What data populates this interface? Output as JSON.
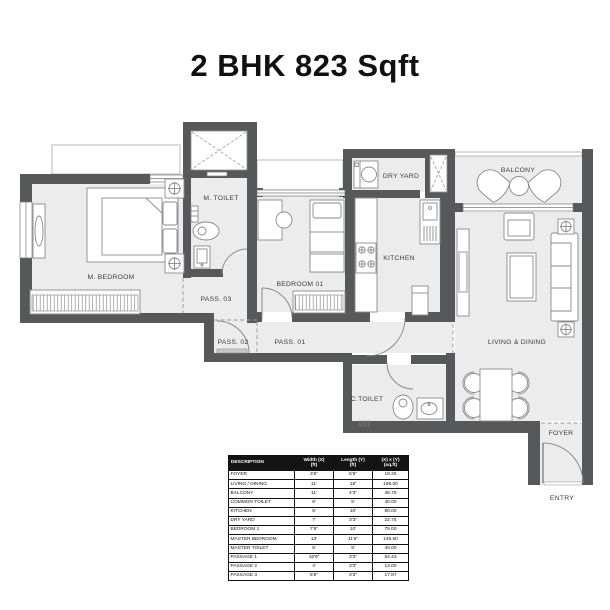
{
  "title": "2 BHK 823 Sqft",
  "plan": {
    "rooms": {
      "m_bedroom": "M. BEDROOM",
      "m_toilet": "M. TOILET",
      "bedroom_01": "BEDROOM 01",
      "kitchen": "KITCHEN",
      "dry_yard": "DRY YARD",
      "balcony": "BALCONY",
      "living_dining": "LIVING & DINING",
      "c_toilet": "C.TOILET",
      "pass_01": "PASS. 01",
      "pass_02": "PASS. 02",
      "pass_03": "PASS. 03",
      "foyer": "FOYER",
      "entry": "ENTRY"
    }
  },
  "table": {
    "headers": {
      "description": "DESCRIPTION",
      "width": "Width (X)",
      "width_unit": "(ft)",
      "length": "Length (Y)",
      "length_unit": "(ft)",
      "area": "(X) x (Y)",
      "area_unit": "(sq.ft)"
    },
    "rows": [
      {
        "d": "FOYER",
        "w": "3'6\"",
        "l": "5'6\"",
        "a": "19.25"
      },
      {
        "d": "LIVING / DINING",
        "w": "11'",
        "l": "18'",
        "a": "198.00"
      },
      {
        "d": "BALCONY",
        "w": "11'",
        "l": "4'3\"",
        "a": "46.75"
      },
      {
        "d": "COMMON TOILET",
        "w": "8'",
        "l": "5'",
        "a": "40.00"
      },
      {
        "d": "KITCHEN",
        "w": "8'",
        "l": "10'",
        "a": "80.00"
      },
      {
        "d": "DRY YARD",
        "w": "7'",
        "l": "3'3\"",
        "a": "22.75"
      },
      {
        "d": "BEDROOM 1",
        "w": "7'6\"",
        "l": "10'",
        "a": "75.00"
      },
      {
        "d": "MASTER BEDROOM",
        "w": "13'",
        "l": "11'6\"",
        "a": "149.50"
      },
      {
        "d": "MASTER TOILET",
        "w": "5'",
        "l": "8'",
        "a": "40.00"
      },
      {
        "d": "PASSAGE 1",
        "w": "16'9\"",
        "l": "3'3\"",
        "a": "54.43"
      },
      {
        "d": "PASSAGE 2",
        "w": "4'",
        "l": "3'3\"",
        "a": "13.00"
      },
      {
        "d": "PASSAGE 3",
        "w": "5'6\"",
        "l": "3'3\"",
        "a": "17.87"
      }
    ]
  }
}
